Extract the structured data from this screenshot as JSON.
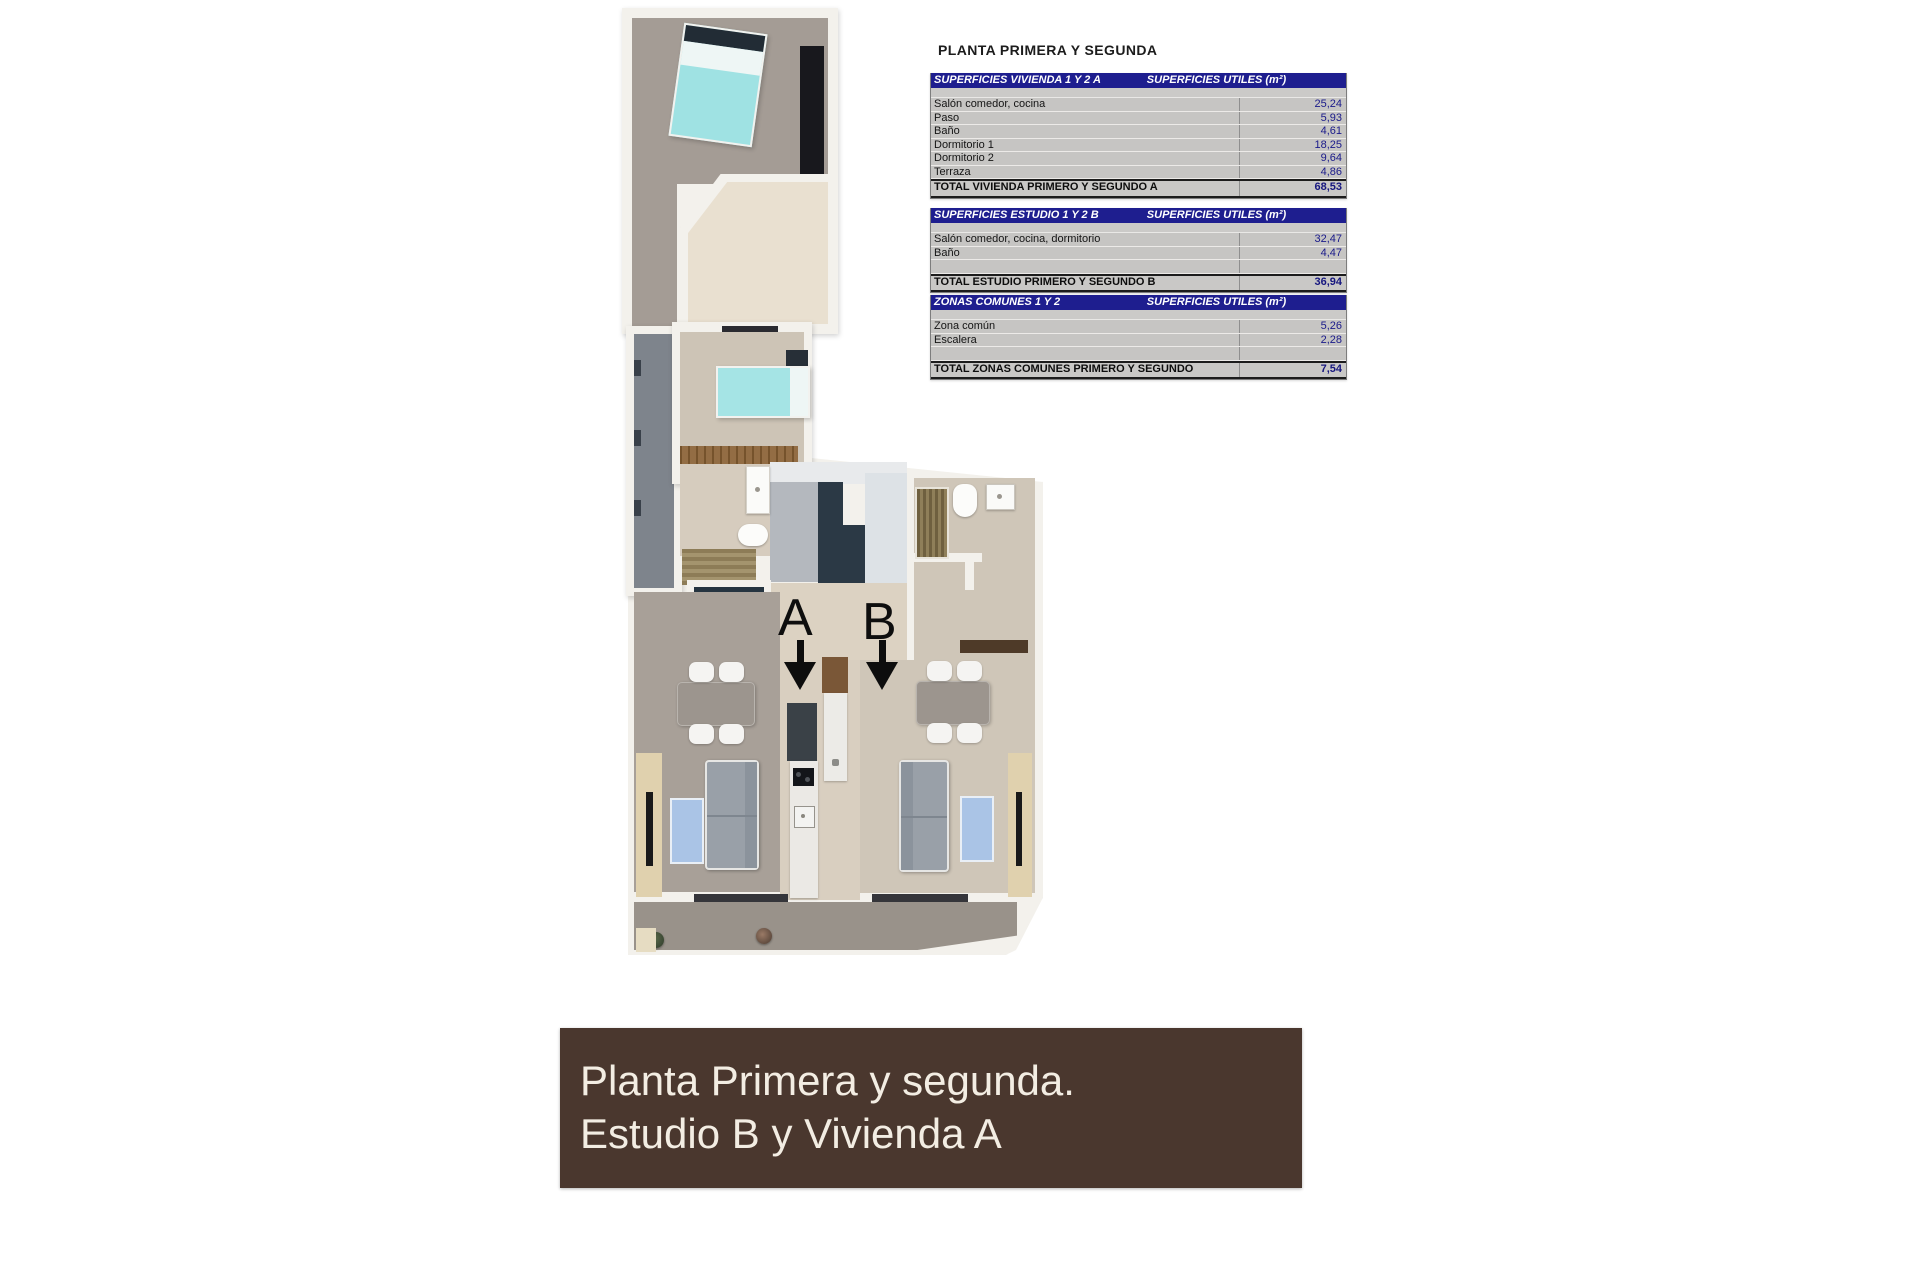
{
  "title": "PLANTA PRIMERA Y SEGUNDA",
  "tables": [
    {
      "header_left": "SUPERFICIES VIVIENDA 1 Y 2 A",
      "header_right": "SUPERFICIES UTILES  (m²)",
      "rows": [
        {
          "label": "Salón comedor, cocina",
          "value": "25,24"
        },
        {
          "label": "Paso",
          "value": "5,93"
        },
        {
          "label": "Baño",
          "value": "4,61"
        },
        {
          "label": "Dormitorio 1",
          "value": "18,25"
        },
        {
          "label": "Dormitorio 2",
          "value": "9,64"
        },
        {
          "label": "Terraza",
          "value": "4,86"
        }
      ],
      "total_label": "TOTAL VIVIENDA PRIMERO Y SEGUNDO A",
      "total_value": "68,53"
    },
    {
      "header_left": "SUPERFICIES ESTUDIO 1 Y 2 B",
      "header_right": "SUPERFICIES UTILES  (m²)",
      "rows": [
        {
          "label": "Salón comedor, cocina, dormitorio",
          "value": "32,47"
        },
        {
          "label": "Baño",
          "value": "4,47"
        }
      ],
      "total_label": "TOTAL ESTUDIO PRIMERO Y SEGUNDO B",
      "total_value": "36,94"
    },
    {
      "header_left": "ZONAS COMUNES 1 Y 2",
      "header_right": "SUPERFICIES UTILES  (m²)",
      "rows": [
        {
          "label": "Zona común",
          "value": "5,26"
        },
        {
          "label": "Escalera",
          "value": "2,28"
        }
      ],
      "total_label": "TOTAL ZONAS COMUNES PRIMERO Y SEGUNDO",
      "total_value": "7,54"
    }
  ],
  "floor_plan": {
    "unit_a_label": "A",
    "unit_b_label": "B"
  },
  "banner": {
    "line1": "Planta Primera y segunda.",
    "line2": "Estudio B y Vivienda A"
  },
  "colors": {
    "table_header_bg": "#1e1e8f",
    "table_row_bg": "#c6c5c3",
    "table_value_text": "#1a1a8a",
    "banner_bg": "#4a372e",
    "banner_text": "#f3ede3"
  }
}
